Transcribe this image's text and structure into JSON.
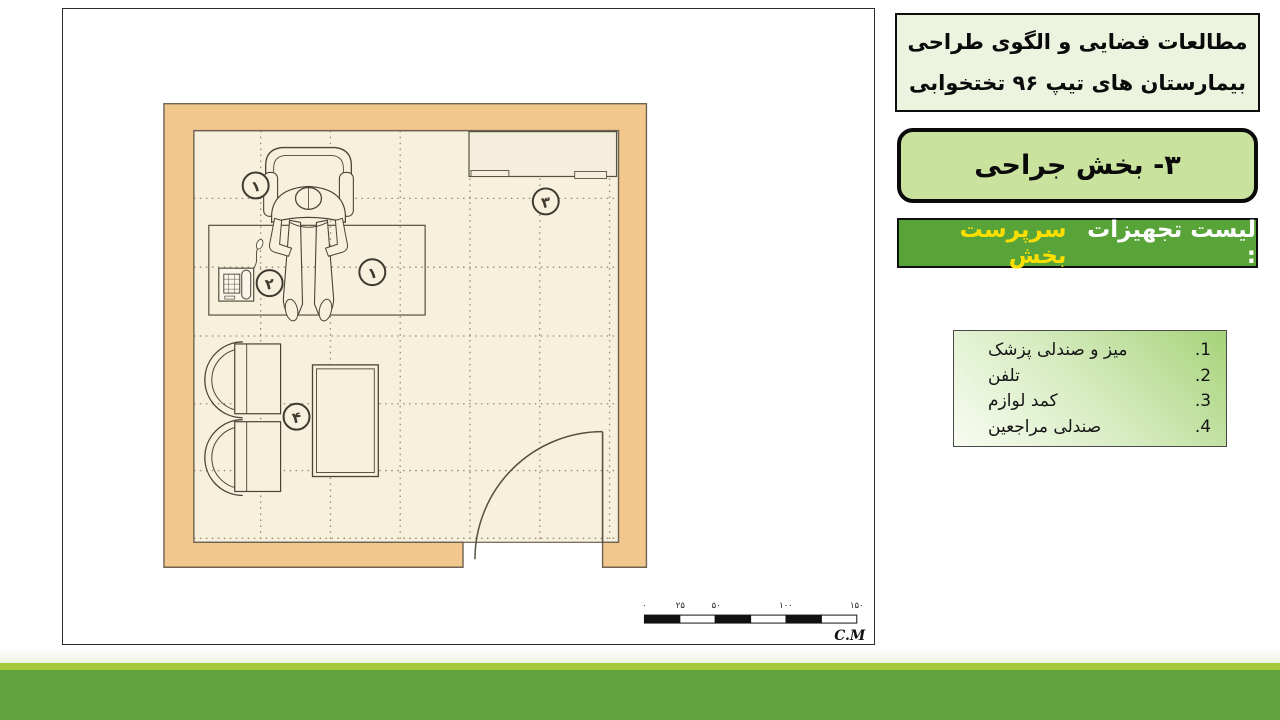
{
  "header": {
    "title_line1": "مطالعات فضایی و الگوی طراحی",
    "title_line2": "بیمارستان های تیپ ۹۶ تختخوابی"
  },
  "section": {
    "label": "۳- بخش جراحی"
  },
  "equipment_bar": {
    "prefix": "لیست تجهیزات :",
    "room_name": "سرپرست بخش"
  },
  "equipment_list": {
    "items": [
      {
        "num": "1.",
        "label": "میز و صندلی پزشک"
      },
      {
        "num": "2.",
        "label": "تلفن"
      },
      {
        "num": "3.",
        "label": "کمد لوازم"
      },
      {
        "num": "4.",
        "label": "صندلی مراجعین"
      }
    ]
  },
  "floor_plan": {
    "callouts": {
      "doctor_chair": "۱",
      "desk": "۱",
      "phone": "۲",
      "cabinet": "۳",
      "visitor_chairs": "۴"
    },
    "scale_bar": {
      "ticks": [
        "۰",
        "۲۵",
        "۵۰",
        "۱۰۰",
        "۱۵۰"
      ],
      "unit": "C.M"
    }
  },
  "colors": {
    "wall": "#f2c78e",
    "floor": "#f7f0dd",
    "band_green": "#60a23c",
    "accent_green": "#a4c93e",
    "bar_green": "#58a439",
    "box_green": "#c9e29e",
    "highlight_yellow": "#ffdf00"
  }
}
